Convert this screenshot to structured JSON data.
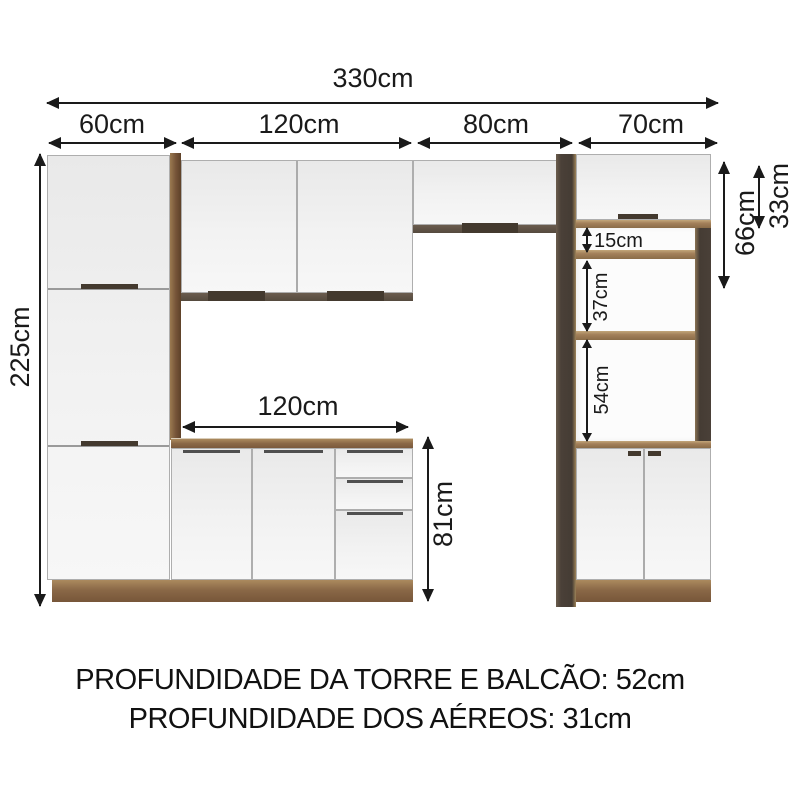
{
  "diagram": {
    "top_dims": {
      "total": "330cm",
      "sections": [
        {
          "label": "60cm"
        },
        {
          "label": "120cm"
        },
        {
          "label": "80cm"
        },
        {
          "label": "70cm"
        }
      ]
    },
    "left_dim": {
      "total_height": "225cm"
    },
    "right_dims": {
      "upper_total": "66cm",
      "hood_height": "33cm"
    },
    "tower_dims": [
      {
        "label": "15cm"
      },
      {
        "label": "37cm"
      },
      {
        "label": "54cm"
      }
    ],
    "counter_dims": {
      "width": "120cm",
      "height": "81cm"
    }
  },
  "footer": {
    "line1": "PROFUNDIDADE DA TORRE E BALCÃO: 52cm",
    "line2": "PROFUNDIDADE DOS AÉREOS: 31cm"
  },
  "colors": {
    "background": "#ffffff",
    "dimension_line": "#1a1a1a",
    "cabinet_front": "#f0f0f0",
    "wood": "#8a6847",
    "wood_light": "#b79c72",
    "dark_panel": "#453c34"
  }
}
